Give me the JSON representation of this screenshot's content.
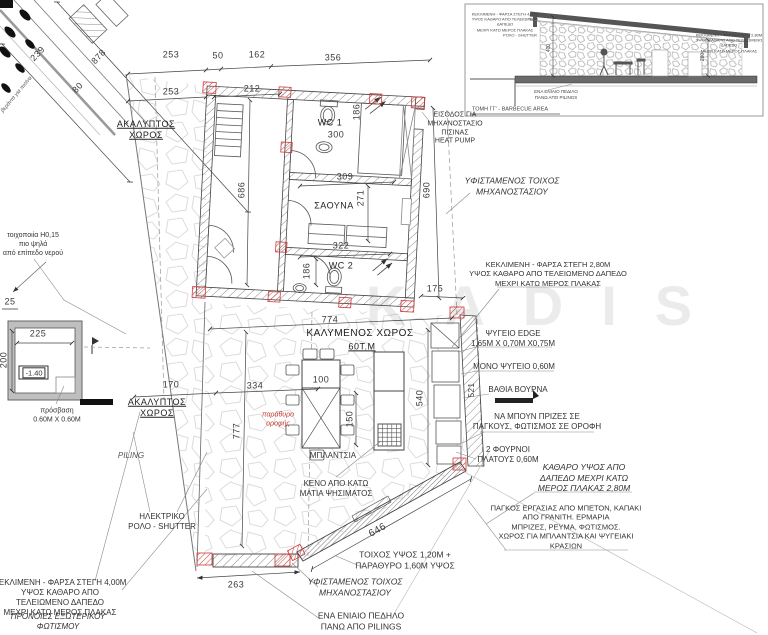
{
  "plan": {
    "watermark": "KADIS",
    "colors": {
      "accent_red": "#c0392b",
      "line": "#3a3a3a",
      "stone": "#dcdcdc"
    },
    "rooms": {
      "open_top": "ΑΚΑΛΥΠΤΟΣ\nΧΩΡΟΣ",
      "wc1": "WC 1",
      "sauna": "ΣΑΟΥΝΑ",
      "wc2": "WC 2",
      "covered": "ΚΑΛΥΜΕΝΟΣ ΧΩΡΟΣ",
      "covered_area": "60Τ.Μ",
      "open_left": "ΑΚΑΛΥΠΤΟΣ\nΧΩΡΟΣ"
    },
    "dims": {
      "road_239": "239",
      "road_878": "878",
      "road_80": "80",
      "t253a": "253",
      "t50": "50",
      "t162": "162",
      "t356": "356",
      "t253b": "253",
      "t212": "212",
      "w300": "300",
      "w186a": "186",
      "v686": "686",
      "v690": "690",
      "s309": "309",
      "s271": "271",
      "s322": "322",
      "w186b": "186",
      "e175": "175",
      "c774": "774",
      "t100": "100",
      "t150": "150",
      "l334": "334",
      "l170": "170",
      "v777": "777",
      "v540": "540",
      "v521": "521",
      "b263": "263",
      "d646": "646",
      "p225": "225",
      "p200": "200",
      "p25": "25",
      "level": "-1.40"
    },
    "annotations": {
      "road_note": "βεράντα για πισίνα",
      "heat_pump": "ΕΙΣΟΔΟΣ ΓΙΑ\nΜΗΧΑΝΟΣΤΑΣΙΟ\nΠΙΣΙΝΑΣ\nHEAT PUMP",
      "wall_exist_r": "ΥΦΙΣΤΑΜΕΝΟΣ ΤΟΙΧΟΣ\nΜΗΧΑΝΟΣΤΑΣΙΟΥ",
      "roof280": "ΚΕΚΛΙΜΕΝΗ - ΦΑΡΣΑ ΣΤΕΓΗ 2,80Μ\nΥΨΟΣ ΚΑΘΑΡΟ ΑΠΟ ΤΕΛΕΙΩΜΕΝΟ ΔΑΠΕΔΟ\nΜΕΧΡΙ ΚΑΤΩ ΜΕΡΟΣ ΠΛΑΚΑΣ",
      "fridge": "ΨΥΓΕΙΟ EDGE\n1,65Μ X 0,70Μ X0,75Μ",
      "mono_fridge": "ΜΟΝΟ ΨΥΓΕΙΟ 0,60Μ",
      "vourna": "ΒΑΘΙΑ ΒΟΥΡΝΑ",
      "sockets": "ΝΑ ΜΠΟΥΝ ΠΡΙΖΕΣ ΣΕ\nΠΑΓΚΟΥΣ, ΦΩΤΙΣΜΟΣ ΣΕ ΟΡΟΦΗ",
      "ovens": "2 ΦΟΥΡΝΟΙ\nΠΛΑΤΟΥΣ 0,60Μ",
      "clear_height": "ΚΑΘΑΡΟ ΥΨΟΣ ΑΠΟ\nΔΑΠΕΔΟ ΜΕΧΡΙ ΚΑΤΩ\nΜΕΡΟΣ ΠΛΑΚΑΣ 2,80Μ",
      "worktop": "ΠΑΓΚΟΣ ΕΡΓΑΣΙΑΣ ΑΠΟ ΜΠΕΤΟΝ, ΚΑΠΑΚΙ\nΑΠΟ ΓΡΑΝΙΤΗ. ΕΡΜΑΡΙΑ\nΜΠΡΙΖΕΣ, ΡΕΥΜΑ, ΦΩΤΙΣΜΟΣ.\nΧΩΡΟΣ ΓΙΑ ΜΠΛΑΝΤΣΙΑ ΚΑΙ ΨΥΓΕΙΑΚΙ\nΚΡΑΣΙΩΝ",
      "wall_window": "ΤΟΙΧΟΣ ΥΨΟΣ 1,20Μ +\nΠΑΡΑΘΥΡΟ 1,60Μ ΥΨΟΣ",
      "wall_exist_b": "ΥΦΙΣΤΑΜΕΝΟΣ ΤΟΙΧΟΣ\nΜΗΧΑΝΟΣΤΑΣΙΟΥ",
      "footing": "ΕΝΑ ΕΝΙΑΙΟ ΠΕΔΗΛΟ\nΠΑΝΩ ΑΠΟ PILINGS",
      "roof400": "ΚΕΚΛΙΜΕΝΗ - ΦΑΡΣΑ ΣΤΕΓΗ 4,00Μ\nΥΨΟΣ ΚΑΘΑΡΟ ΑΠΟ\nΤΕΛΕΙΩΜΕΝΟ ΔΑΠΕΔΟ\nΜΕΧΡΙ ΚΑΤΩ ΜΕΡΟΣ ΠΛΑΚΑΣ",
      "provisions": "ΠΡΟΝΟΙΕΣ ΕΞΩΤΕΡΙΚΟΥ\nΦΩΤΙΣΜΟΥ",
      "shutter": "ΗΛΕΚΤΡΙΚΟ\nΡΟΛΟ - SHUTTER",
      "void_below": "ΚΕΝΟ ΑΠΟ ΚΑΤΩ\nΜΑΤΙΑ ΨΗΣΙΜΑΤΟΣ",
      "blantzia": "ΜΠΛΑΝΤΣΙΑ",
      "roof_window": "παράθυρο\nοροφής",
      "piling": "PILING",
      "masonry": "τοιχοποιία Η0,15\nπιο ψηλά\nαπό επίπεδο νερού",
      "access": "πρόσβαση\n0.60Μ X 0.60Μ"
    }
  },
  "section": {
    "roof4": "ΚΕΚΛΙΜΕΝΗ - ΦΑΡΣΑ ΣΤΕΓΗ 4,00Μ\nΥΨΟΣ ΚΑΘΑΡΟ ΑΠΟ ΤΕΛΕΙΩΜΕΝΟ ΔΑΠΕΔΟ\nΜΕΧΡΙ ΚΑΤΩ ΜΕΡΟΣ ΠΛΑΚΑΣ",
    "shutter": "ΡΟΛΟ - SHUTTER",
    "roof28": "ΚΕΚΛΙΜΕΝΗ - ΦΑΡΣΑ ΣΤΕΓΗ 2,80Μ\nΥΨΟΣ ΚΑΘΑΡΟ ΑΠΟ ΤΕΛΕΙΩΜΕΝΟ ΔΑΠΕΔΟ\nΜΕΧΡΙ ΚΑΤΩ ΜΕΡΟΣ ΠΛΑΚΑΣ",
    "d400": "400",
    "d280": "280",
    "footing": "ΕΝΑ ΕΝΙΑΙΟ ΠΕΔΙΛΟ\nΠΑΝΩ ΑΠΟ PILINGS",
    "caption": "ΤΟΜΗ ΓΓ' - BARBECUE AREA"
  }
}
